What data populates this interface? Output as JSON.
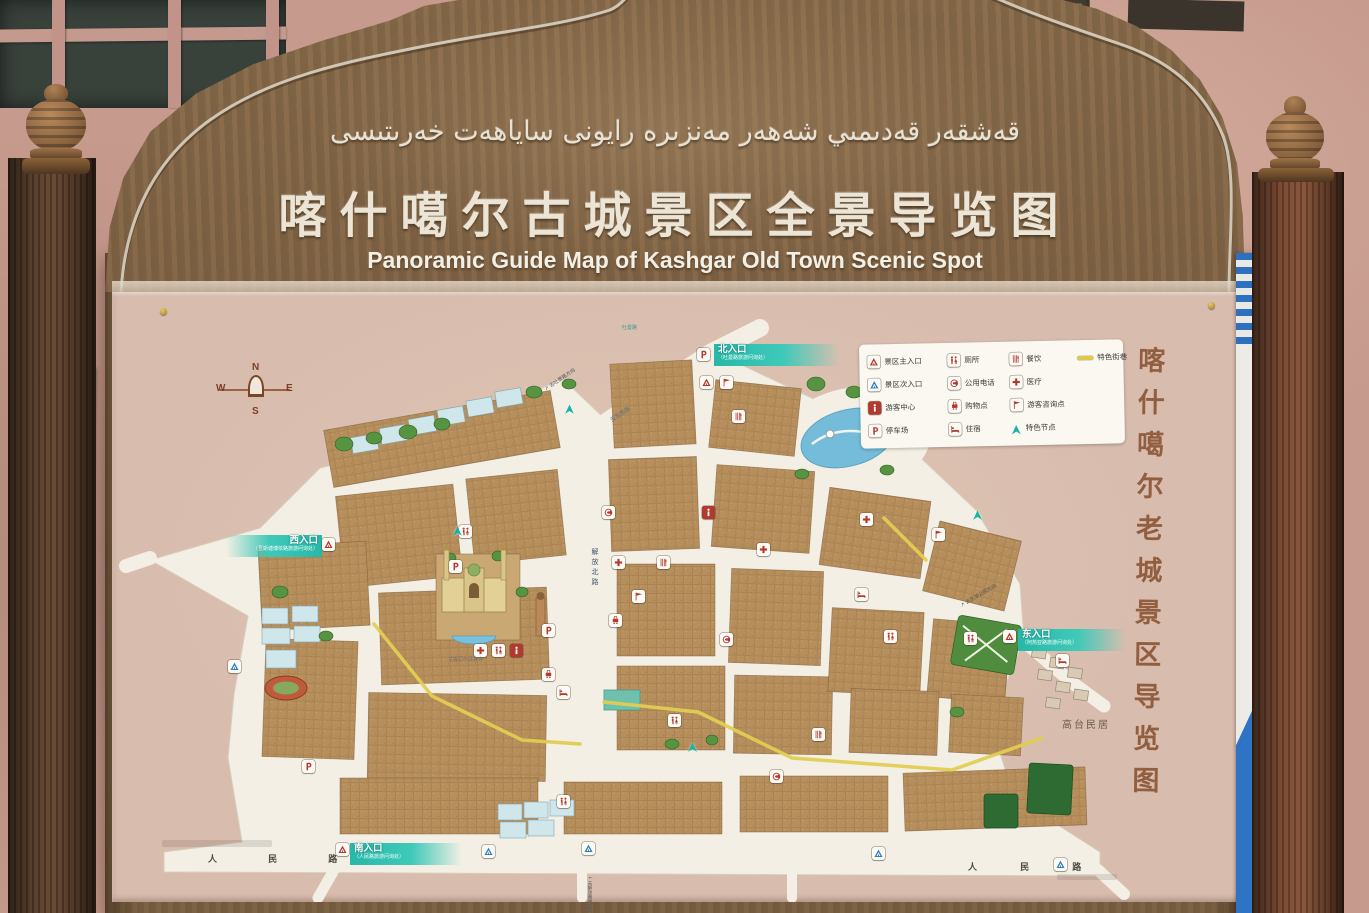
{
  "signboard": {
    "title_uyghur": "قەشقەر قەدىمىي شەھەر مەنزىرە رايونى ساياھەت خەرىتىسى",
    "title_chinese": "喀什噶尔古城景区全景导览图",
    "title_english": "Panoramic Guide Map of Kashgar Old Town Scenic Spot",
    "side_caption_vertical": "喀什噶尔老城景区导览图",
    "side_sign_text": "EDHIM"
  },
  "legend": {
    "items": [
      {
        "name": "main-entrance",
        "label": "景区主入口"
      },
      {
        "name": "toilet",
        "label": "厕所"
      },
      {
        "name": "dining",
        "label": "餐饮"
      },
      {
        "name": "featured-street",
        "label": "特色街巷"
      },
      {
        "name": "secondary-entrance",
        "label": "景区次入口"
      },
      {
        "name": "public-phone",
        "label": "公用电话"
      },
      {
        "name": "medical",
        "label": "医疗"
      },
      {
        "name": "visitor-center",
        "label": "游客中心"
      },
      {
        "name": "shopping",
        "label": "购物点"
      },
      {
        "name": "info-point",
        "label": "游客咨询点"
      },
      {
        "name": "parking",
        "label": "停车场"
      },
      {
        "name": "lodging",
        "label": "住宿"
      },
      {
        "name": "featured-node",
        "label": "特色节点"
      }
    ]
  },
  "compass": {
    "n": "N",
    "s": "S",
    "e": "E",
    "w": "W"
  },
  "entrances": {
    "north": {
      "label": "北入口",
      "note": "（吐曼路旅游问询处）"
    },
    "west": {
      "label": "西入口",
      "note": "（吾斯塘博依路旅游问询处）"
    },
    "east": {
      "label": "东入口",
      "note": "（阿热亚路旅游问询处）"
    },
    "south": {
      "label": "南入口",
      "note": "（人民路旅游问询处）"
    }
  },
  "roads": {
    "renmin_west": "人 民 路",
    "renmin_east": "人 民 路",
    "jiefang_north": "解放北路",
    "yawage": "亚瓦格路",
    "tuman": "吐曼路"
  },
  "places": {
    "gaotai": "高台民居",
    "idkah": "艾提尕尔清真寺"
  },
  "directions": {
    "to_tuman": "去吐曼路方向",
    "to_donghu": "去东湖公园方向",
    "to_jiefang_south": "去解放南路方向"
  }
}
